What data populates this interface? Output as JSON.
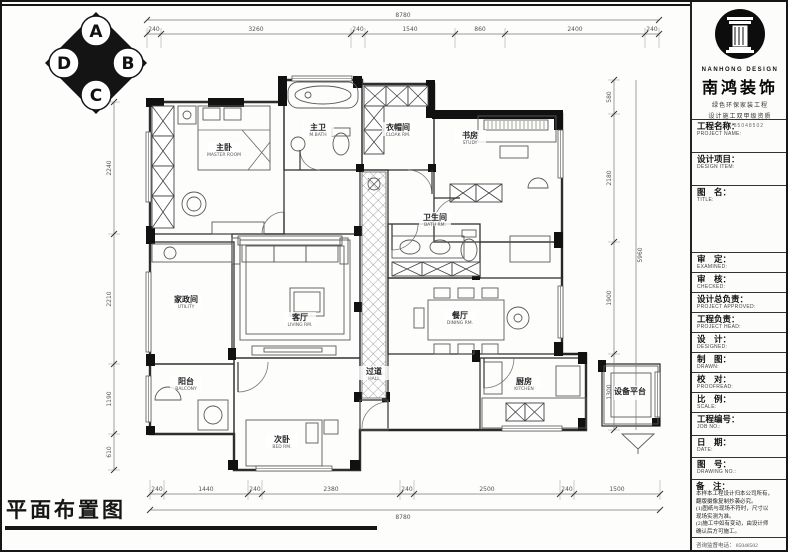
{
  "page": {
    "drawing_title": "平面布置图"
  },
  "compass": {
    "letters": [
      "A",
      "B",
      "C",
      "D"
    ]
  },
  "floor_plan": {
    "rooms": [
      {
        "id": "master-bedroom",
        "name": "主卧",
        "en": "MASTER ROOM"
      },
      {
        "id": "master-bath",
        "name": "主卫",
        "en": "M.BATH"
      },
      {
        "id": "cloak-room",
        "name": "衣帽间",
        "en": "CLOAK RM."
      },
      {
        "id": "study",
        "name": "书房",
        "en": "STUDY"
      },
      {
        "id": "living-room",
        "name": "客厅",
        "en": "LIVING RM."
      },
      {
        "id": "hallway",
        "name": "过道",
        "en": "HALL"
      },
      {
        "id": "bathroom",
        "name": "卫生间",
        "en": "BATH RM."
      },
      {
        "id": "dining-room",
        "name": "餐厅",
        "en": "DINING RM."
      },
      {
        "id": "kitchen",
        "name": "厨房",
        "en": "KITCHEN"
      },
      {
        "id": "second-bedroom",
        "name": "次卧",
        "en": "BED RM."
      },
      {
        "id": "balcony",
        "name": "阳台",
        "en": "BALCONY"
      },
      {
        "id": "utility-room",
        "name": "家政间",
        "en": "UTILITY"
      },
      {
        "id": "equip-platform",
        "name": "设备平台",
        "en": ""
      }
    ],
    "dimensions": {
      "top": {
        "total": "8780",
        "segments": [
          "240",
          "3260",
          "240",
          "1540",
          "860",
          "2400",
          "240"
        ]
      },
      "bottom": {
        "total": "8780",
        "segments": [
          "240",
          "1440",
          "240",
          "2380",
          "240",
          "2500",
          "240",
          "1500"
        ]
      },
      "right": {
        "total": "5960",
        "segments": [
          "580",
          "2180",
          "1900",
          "1300"
        ]
      },
      "left": {
        "segments": [
          "2240",
          "2210",
          "1190",
          "610"
        ]
      }
    }
  },
  "title_block": {
    "brand": {
      "logo_en": "NANHONG DESIGN",
      "name": "南鸿装饰",
      "tagline1": "绿色环保家装工程",
      "tagline2": "设计施工双甲级资质",
      "contact": "0571-85048502"
    },
    "rows": [
      {
        "cn": "工程名称：",
        "en": "PROJECT NAME:"
      },
      {
        "cn": "设计项目：",
        "en": "DESIGN ITEM:"
      },
      {
        "cn": "图　名：",
        "en": "TITLE:"
      },
      {
        "cn": "审　定：",
        "en": "EXAMINED:"
      },
      {
        "cn": "审　核：",
        "en": "CHECKED:"
      },
      {
        "cn": "设计总负责：",
        "en": "PROJECT APPROVED:"
      },
      {
        "cn": "工程负责：",
        "en": "PROJECT HEAD:"
      },
      {
        "cn": "设　计：",
        "en": "DESIGNED:"
      },
      {
        "cn": "制　图：",
        "en": "DRAWN:"
      },
      {
        "cn": "校　对：",
        "en": "PROOFREAD:"
      },
      {
        "cn": "比　例：",
        "en": "SCALE:"
      },
      {
        "cn": "工程编号：",
        "en": "JOB NO.:"
      },
      {
        "cn": "日　期：",
        "en": "DATE:"
      },
      {
        "cn": "图　号：",
        "en": "DRAWING NO.:"
      }
    ],
    "notes": {
      "label": "备　注：",
      "lines": [
        "本样本工程设计归本公司所有，",
        "翻版摄像复制抄袭必究。",
        "(1)图纸与现场不符时，尺寸以",
        "现场实测为准。",
        "(2)施工中如有变动，由设计师",
        "确认后方可施工。"
      ]
    },
    "phone": "咨询监督电话： 85048502"
  }
}
